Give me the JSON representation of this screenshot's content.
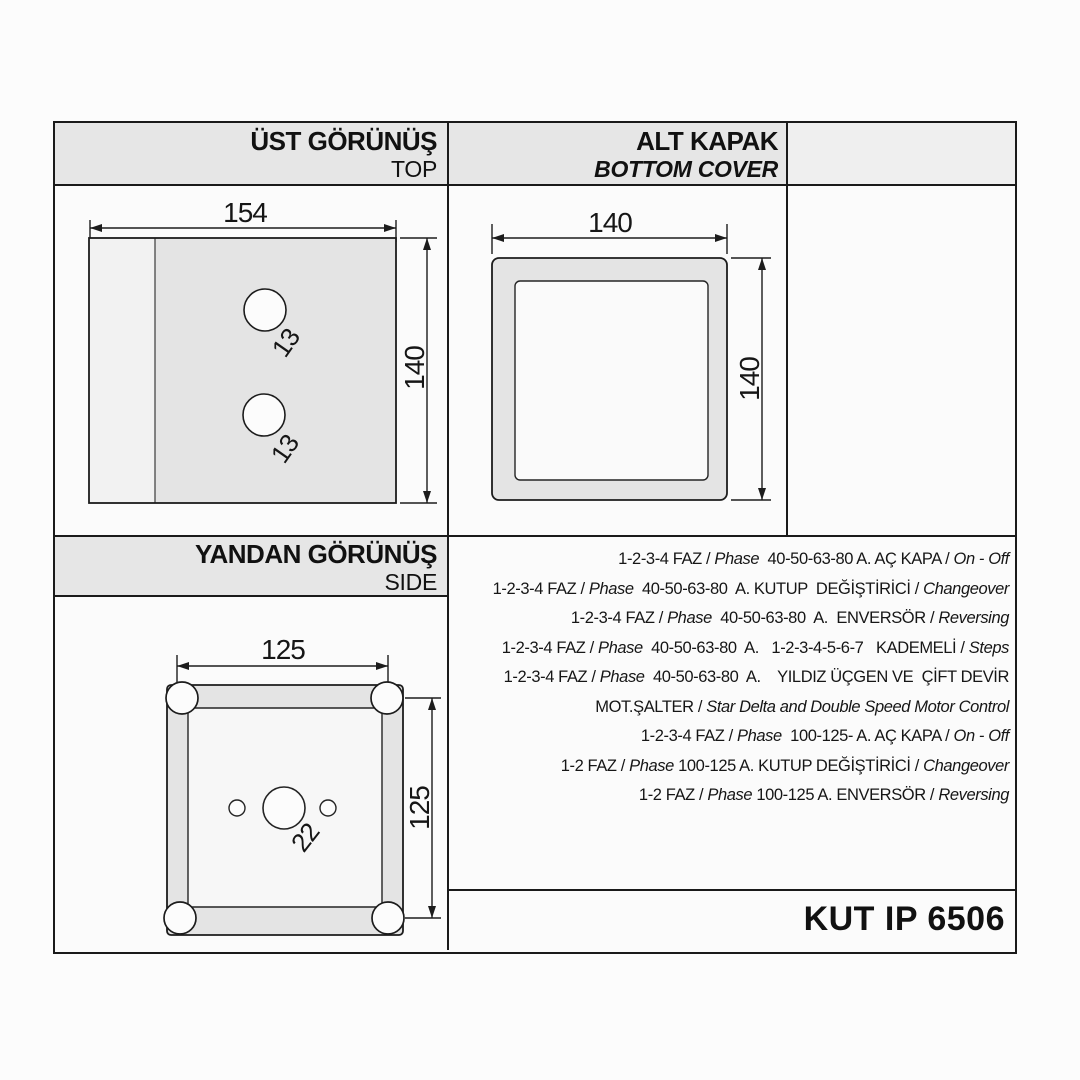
{
  "product": {
    "code": "KUT IP 6506"
  },
  "sections": {
    "top_view": {
      "title": "ÜST GÖRÜNÜŞ",
      "subtitle": "TOP",
      "width": "154",
      "height": "140",
      "hole_top": "13",
      "hole_bottom": "13"
    },
    "bottom_cover": {
      "title": "ALT KAPAK",
      "subtitle": "BOTTOM COVER",
      "width": "140",
      "height": "140"
    },
    "side_view": {
      "title": "YANDAN GÖRÜNÜŞ",
      "subtitle": "SIDE",
      "width": "125",
      "height": "125",
      "hole": "22"
    }
  },
  "specs": {
    "lines": [
      [
        {
          "t": "1-2-3-4 FAZ / ",
          "i": false
        },
        {
          "t": "Phase",
          "i": true
        },
        {
          "t": "  40-50-63-80 A. AÇ KAPA / ",
          "i": false
        },
        {
          "t": "On - Off",
          "i": true
        }
      ],
      [
        {
          "t": "1-2-3-4 FAZ / ",
          "i": false
        },
        {
          "t": "Phase",
          "i": true
        },
        {
          "t": "  40-50-63-80  A. KUTUP  DEĞİŞTİRİCİ / ",
          "i": false
        },
        {
          "t": "Changeover",
          "i": true
        }
      ],
      [
        {
          "t": "1-2-3-4 FAZ / ",
          "i": false
        },
        {
          "t": "Phase",
          "i": true
        },
        {
          "t": "  40-50-63-80  A.  ENVERSÖR / ",
          "i": false
        },
        {
          "t": "Reversing",
          "i": true
        }
      ],
      [
        {
          "t": "1-2-3-4 FAZ / ",
          "i": false
        },
        {
          "t": "Phase",
          "i": true
        },
        {
          "t": "  40-50-63-80  A.   1-2-3-4-5-6-7   KADEMELİ / ",
          "i": false
        },
        {
          "t": "Steps",
          "i": true
        }
      ],
      [
        {
          "t": "1-2-3-4 FAZ / ",
          "i": false
        },
        {
          "t": "Phase",
          "i": true
        },
        {
          "t": "  40-50-63-80  A.    YILDIZ ÜÇGEN VE  ÇİFT DEVİR",
          "i": false
        }
      ],
      [
        {
          "t": "MOT.ŞALTER / ",
          "i": false
        },
        {
          "t": "Star Delta and Double Speed Motor Control",
          "i": true
        }
      ],
      [
        {
          "t": "1-2-3-4 FAZ / ",
          "i": false
        },
        {
          "t": "Phase",
          "i": true
        },
        {
          "t": "  100-125- A. AÇ KAPA / ",
          "i": false
        },
        {
          "t": "On - Off",
          "i": true
        }
      ],
      [
        {
          "t": "1-2 FAZ / ",
          "i": false
        },
        {
          "t": "Phase",
          "i": true
        },
        {
          "t": " 100-125 A. KUTUP DEĞİŞTİRİCİ / ",
          "i": false
        },
        {
          "t": "Changeover",
          "i": true
        }
      ],
      [
        {
          "t": "1-2 FAZ / ",
          "i": false
        },
        {
          "t": "Phase",
          "i": true
        },
        {
          "t": " 100-125 A. ENVERSÖR / ",
          "i": false
        },
        {
          "t": "Reversing",
          "i": true
        }
      ]
    ]
  },
  "colors": {
    "band_gray": "#e6e6e6",
    "paper": "#fbfbfb",
    "line_black": "#1a1a1a",
    "fill_light": "#f2f2f2",
    "fill_mid": "#e4e4e4"
  }
}
